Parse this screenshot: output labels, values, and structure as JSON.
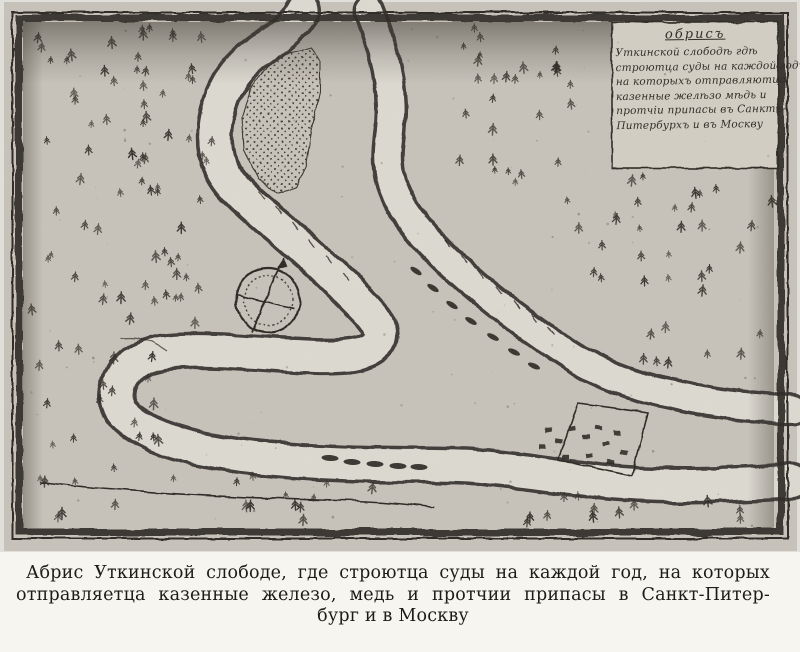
{
  "colors": {
    "ink": "#2b2722",
    "paper": "#d8d4cb",
    "river": "#f0ede5",
    "page_bg": "#f7f5f0",
    "cartouche_bg": "#e4e0d6"
  },
  "cartouche": {
    "title": "обрисъ",
    "lines": [
      "Уткинской слободѣ гдѣ",
      "строютца суды на каждой годъ",
      "на которыхъ отправляютца",
      "казенные желѣзо мѣдь и",
      "протчіи припасы въ Санктъ-",
      "Питербурхъ и въ Москву"
    ]
  },
  "caption": {
    "lines": [
      "Абрис Уткинской слободе, где строютца суды на каждой год, на которых",
      "отправляетца казенные железо, медь и протчии припасы в Санкт-Питер-",
      "бург и в Москву"
    ]
  },
  "icons": {
    "compass": "compass-rose-icon",
    "tree": "fir-tree-icon",
    "boat": "boat-icon",
    "settlement": "settlement-enclosure",
    "island": "stippled-sandbar"
  }
}
